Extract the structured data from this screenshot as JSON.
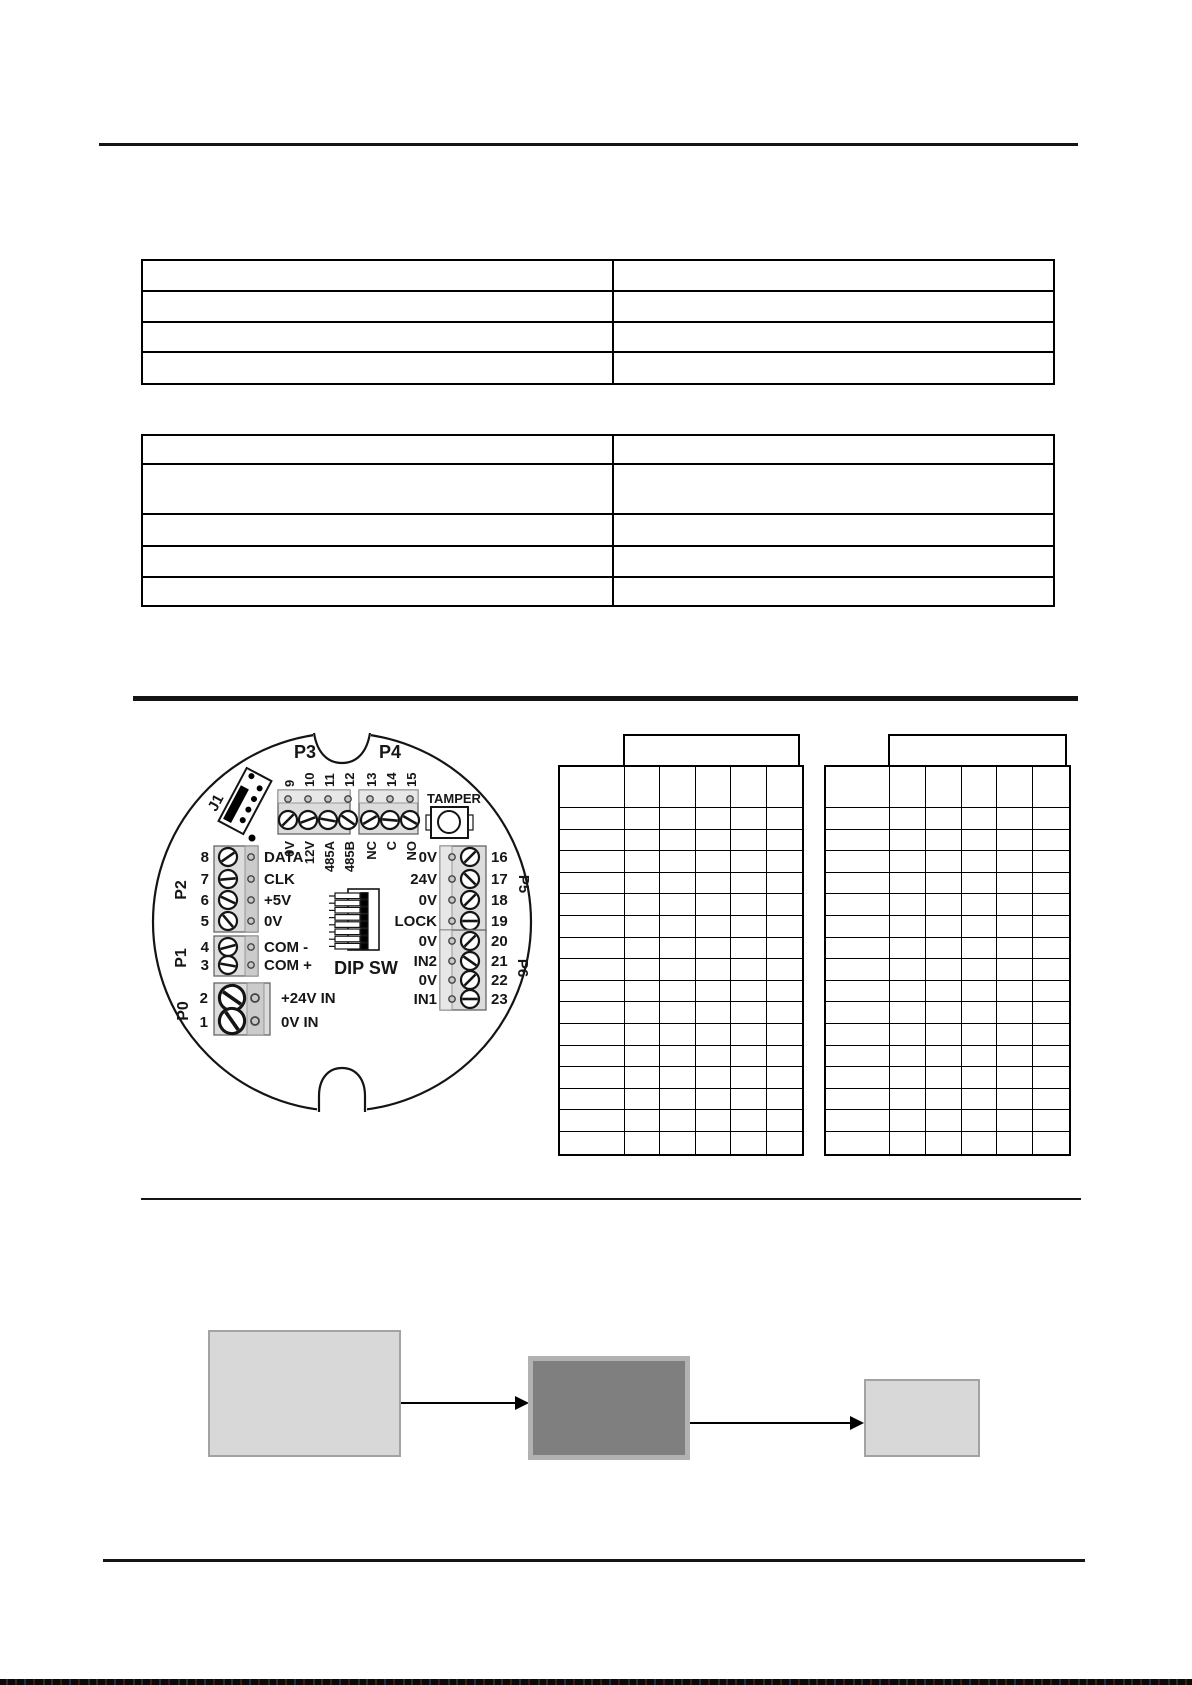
{
  "document": {
    "tables": {
      "table1": {
        "col_widths": [
          469,
          439
        ],
        "row_heights": [
          31,
          31,
          30,
          32
        ],
        "cells": [
          [
            "",
            ""
          ],
          [
            "",
            ""
          ],
          [
            "",
            ""
          ],
          [
            "",
            ""
          ]
        ]
      },
      "table2": {
        "col_widths": [
          469,
          439
        ],
        "row_heights": [
          29,
          50,
          32,
          31,
          29
        ],
        "cells": [
          [
            "",
            ""
          ],
          [
            "",
            ""
          ],
          [
            "",
            ""
          ],
          [
            "",
            ""
          ],
          [
            "",
            ""
          ]
        ]
      },
      "grid1": {
        "header": "",
        "cols": [
          65,
          35.4,
          35.4,
          35.4,
          35.4,
          35.4
        ],
        "first_row_h": 41,
        "body_rows": 16,
        "row_h": 21.6
      },
      "grid2": {
        "header": "",
        "cols": [
          64,
          35.8,
          35.8,
          35.8,
          35.8,
          35.8
        ],
        "first_row_h": 41,
        "body_rows": 16,
        "row_h": 21.6
      }
    }
  },
  "pcb": {
    "connectors": {
      "j1": "J1",
      "p3": "P3",
      "p4": "P4",
      "p2": "P2",
      "p1": "P1",
      "p0": "P0",
      "p5": "P5",
      "p6": "P6",
      "tamper": "TAMPER",
      "dip": "DIP SW"
    },
    "p3_pins": [
      {
        "num": "9",
        "label": "0V"
      },
      {
        "num": "10",
        "label": "12V"
      },
      {
        "num": "11",
        "label": "485A"
      },
      {
        "num": "12",
        "label": "485B"
      }
    ],
    "p4_pins": [
      {
        "num": "13",
        "label": "NC"
      },
      {
        "num": "14",
        "label": "C"
      },
      {
        "num": "15",
        "label": "NO"
      }
    ],
    "p2_pins": [
      {
        "num": "8",
        "label": "DATA"
      },
      {
        "num": "7",
        "label": "CLK"
      },
      {
        "num": "6",
        "label": "+5V"
      },
      {
        "num": "5",
        "label": "0V"
      }
    ],
    "p1_pins": [
      {
        "num": "4",
        "label": "COM -"
      },
      {
        "num": "3",
        "label": "COM +"
      }
    ],
    "p0_pins": [
      {
        "num": "2",
        "label": "+24V IN"
      },
      {
        "num": "1",
        "label": "0V IN"
      }
    ],
    "p5_pins": [
      {
        "label": "0V",
        "num": "16"
      },
      {
        "label": "24V",
        "num": "17"
      },
      {
        "label": "0V",
        "num": "18"
      },
      {
        "label": "LOCK",
        "num": "19"
      }
    ],
    "p6_pins": [
      {
        "label": "0V",
        "num": "20"
      },
      {
        "label": "IN2",
        "num": "21"
      },
      {
        "label": "0V",
        "num": "22"
      },
      {
        "label": "IN1",
        "num": "23"
      }
    ]
  },
  "flow": {
    "box1_label": "",
    "box2_label": "",
    "box3_label": ""
  },
  "colors": {
    "light_gray": "#d8d8d8",
    "dark_gray": "#7f7f7f",
    "border_gray": "#b2b2b2",
    "line_black": "#141414"
  }
}
